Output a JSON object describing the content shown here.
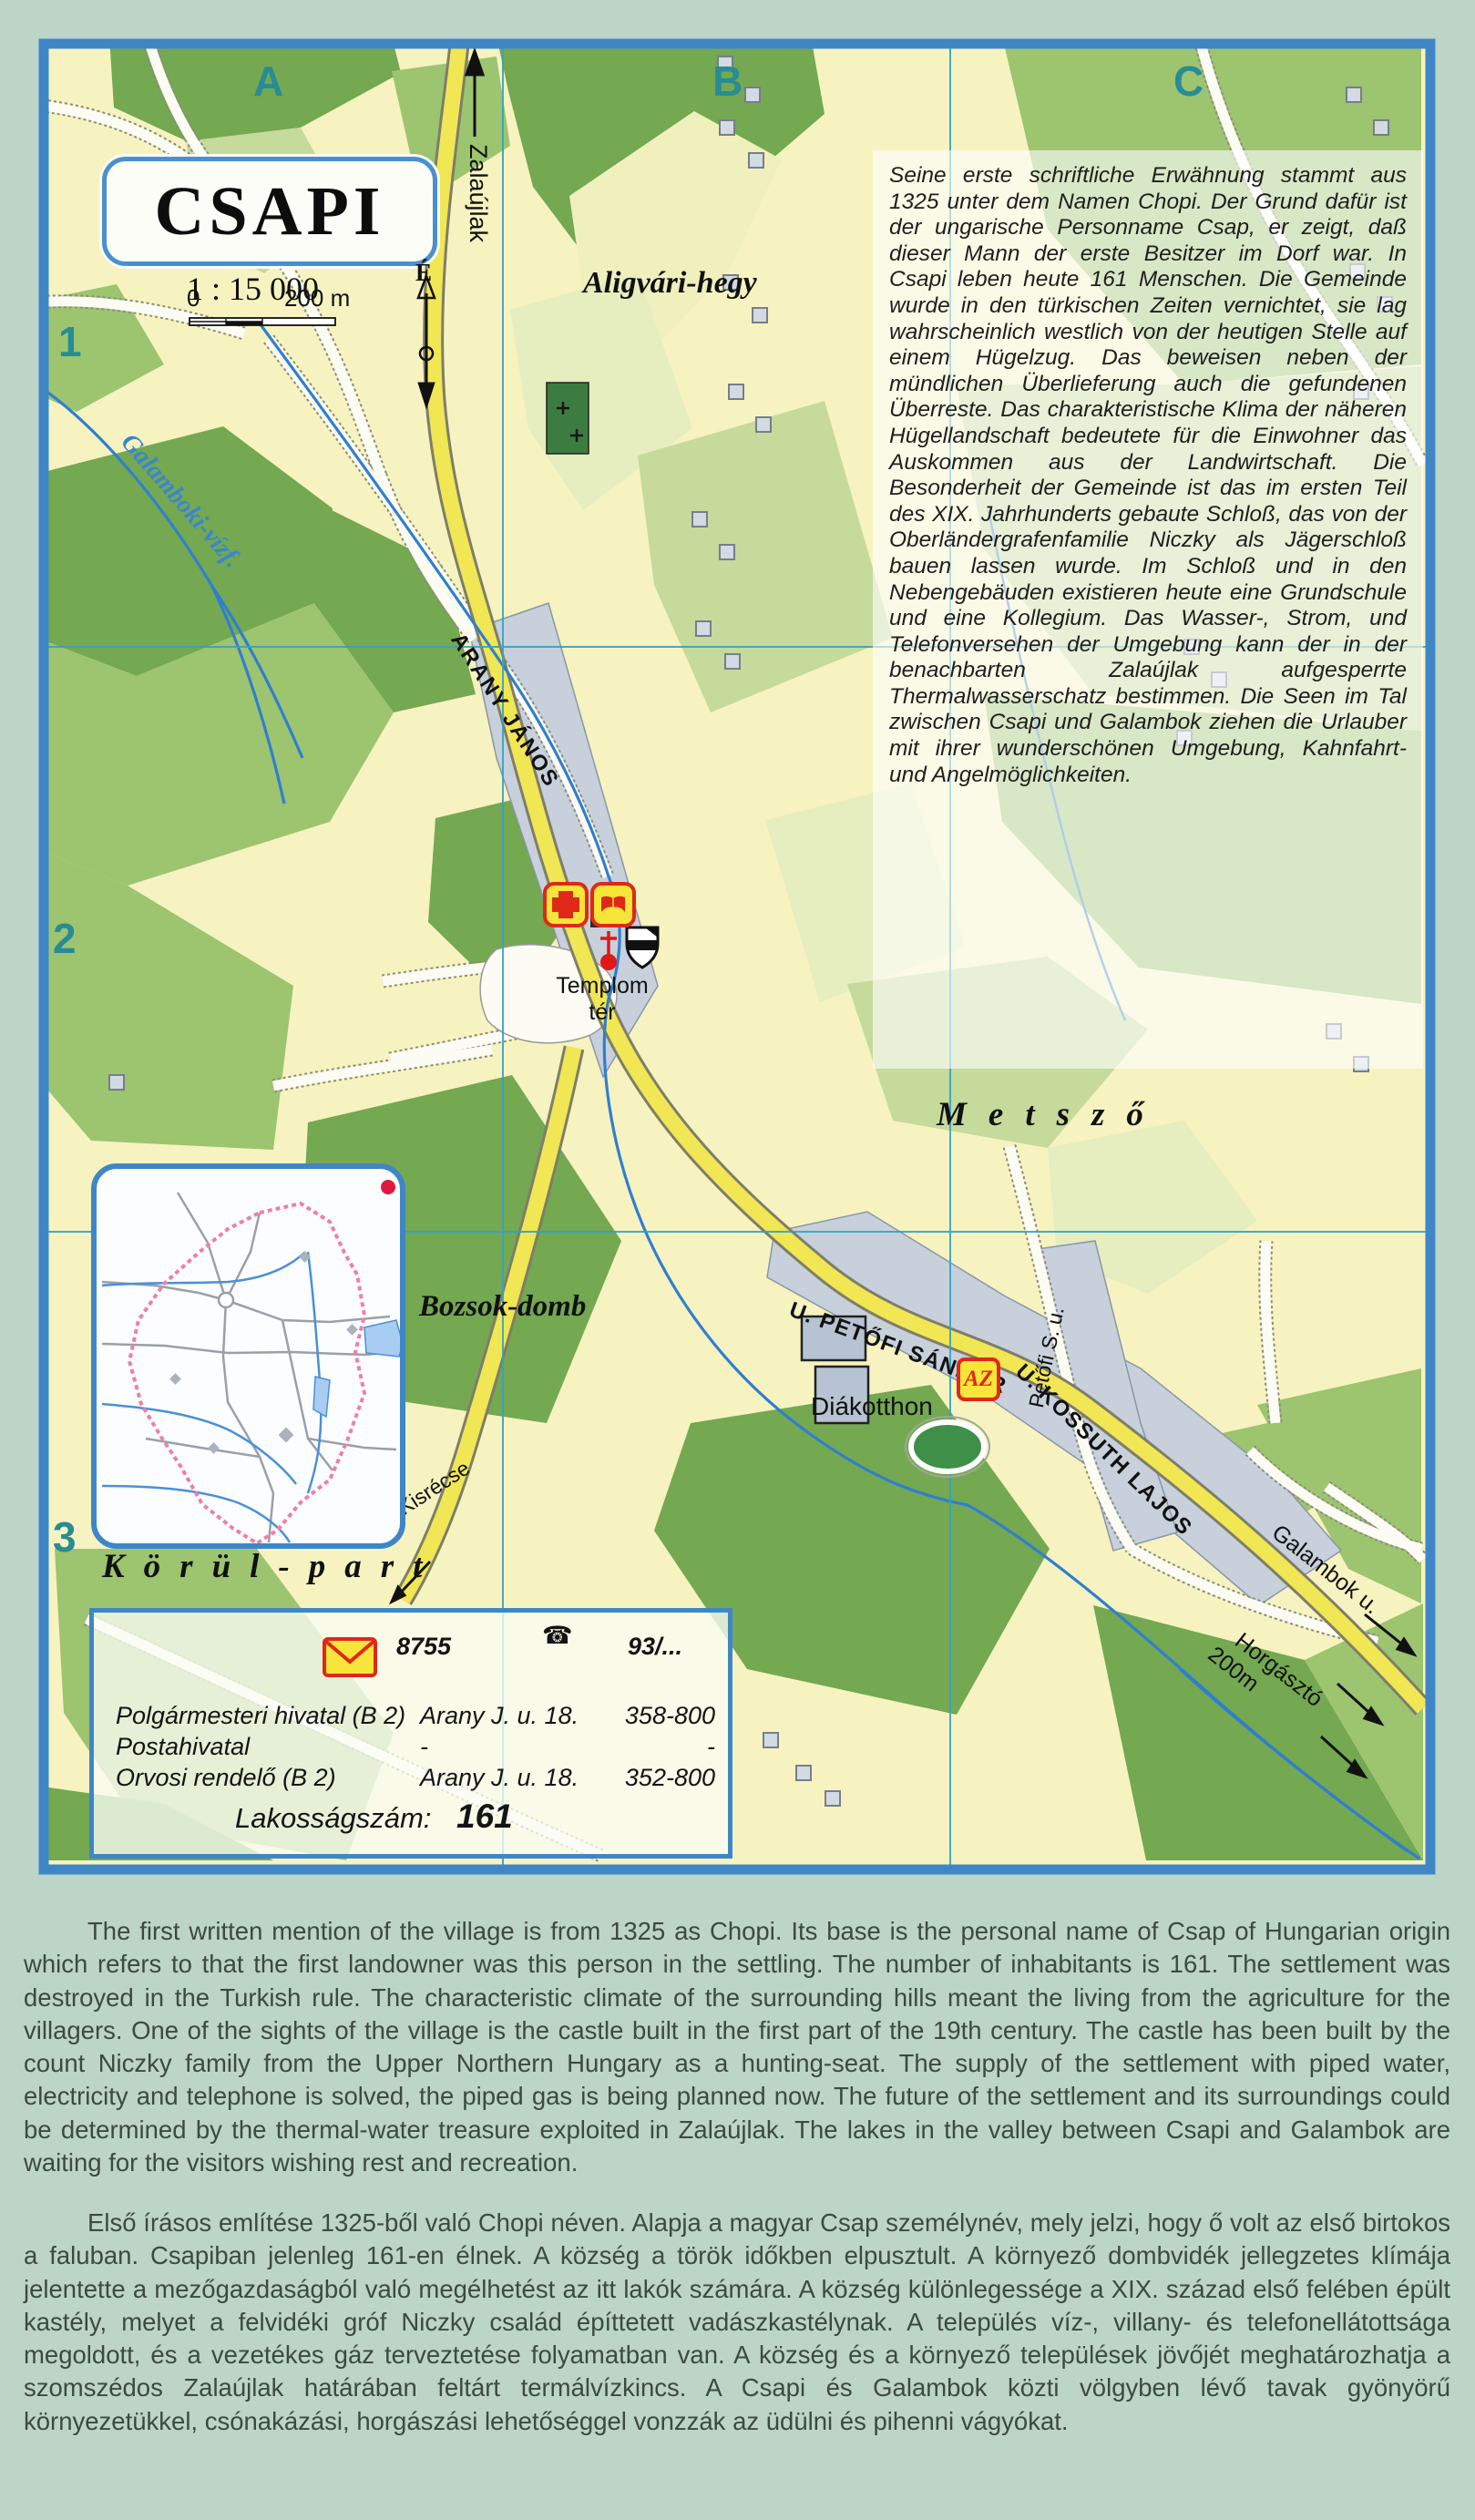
{
  "map": {
    "title": "CSAPI",
    "scale_text": "1 : 15 000",
    "scale_zero": "0",
    "scale_distance": "200 m",
    "north_label": "É",
    "grid": {
      "columns": [
        "A",
        "B",
        "C"
      ],
      "rows": [
        "1",
        "2",
        "3"
      ]
    },
    "labels": {
      "zalaujlak": "Zalaújlak",
      "aligvari_hegy": "Aligvári-hegy",
      "galamboki_vizf": "Galamboki-vízf.",
      "arany_janos": "ARANY JÁNOS",
      "templom_ter_line1": "Templom",
      "templom_ter_line2": "tér",
      "metszo": "Metsző",
      "bozsok_domb": "Bozsok-domb",
      "korul_part": "Körül-part",
      "diakotthon": "Diákotthon",
      "petofi_sandor": "U. PETŐFI SÁNDOR",
      "kossuth_lajos": "U. KOSSUTH LAJOS",
      "petofi_s_u": "Petőfi S. u.",
      "kisrecse": "Kisrécse",
      "galambok_u": "Galambok u.",
      "horgaszto": "Horgásztó",
      "horgaszto_distance": "200m",
      "az_badge": "AZ"
    },
    "icons": {
      "up_arrow": "↑",
      "phone_glyph": "☎"
    },
    "description_de": "Seine erste schriftliche Erwähnung stammt aus 1325 unter dem Namen Chopi. Der Grund dafür ist der ungarische Personname Csap, er zeigt, daß dieser Mann der erste Besitzer im Dorf war. In Csapi  leben heute 161 Menschen. Die Gemeinde wurde in den türkischen Zeiten vernichtet, sie lag wahrscheinlich westlich von der heutigen Stelle auf einem Hügelzug. Das beweisen neben der mündlichen Überlieferung auch die gefundenen Überreste. Das charakteristische Klima der näheren Hügellandschaft bedeutete für die Einwohner das Auskommen aus der Landwirtschaft. Die Besonderheit der Gemeinde ist das  im ersten Teil des XIX. Jahrhunderts gebaute Schloß, das von der Oberländergrafenfamilie Niczky als Jägerschloß bauen lassen wurde. Im Schloß und in den Nebengebäuden existieren heute eine Grundschule und eine Kollegium. Das Wasser-, Strom, und Telefonversehen der Umgebung kann der in der benachbarten Zalaújlak aufgesperrte Thermalwasserschatz bestimmen. Die Seen im Tal zwischen Csapi und Galambok ziehen die Urlauber mit ihrer wunderschönen Umgebung, Kahnfahrt- und Angelmöglichkeiten.",
    "info_box": {
      "postal_code": "8755",
      "phone_prefix": "93/...",
      "entries": [
        {
          "name": "Polgármesteri hivatal (B 2)",
          "address": "Arany J. u. 18.",
          "phone": "358-800"
        },
        {
          "name": "Postahivatal",
          "address": "-",
          "phone": "-"
        },
        {
          "name": "Orvosi rendelő (B 2)",
          "address": "Arany J. u.  18.",
          "phone": "352-800"
        }
      ],
      "population_label": "Lakosságszám:",
      "population_value": "161"
    }
  },
  "description_en": "The first written mention of the village is from 1325 as Chopi. Its base is the personal name of Csap of Hungarian origin which refers to that the first landowner was this person in the settling. The number of inhabitants is 161. The settlement was destroyed in the Turkish rule. The characteristic climate of the surrounding hills meant the living from the agriculture for the villagers. One of the sights of the village is the castle built in the first part of the 19th century. The castle has  been built by the count Niczky family from the Upper Northern Hungary as a hunting-seat. The supply of the settlement with piped water, electricity and telephone is solved,  the piped gas is being planned now. The future of the settlement and its surroundings could be determined by the thermal-water treasure exploited in Zalaújlak. The lakes in the valley between Csapi and Galambok are waiting for the visitors wishing rest and recreation.",
  "description_hu": "Első írásos említése 1325-ből való Chopi néven. Alapja a magyar Csap személynév, mely jelzi, hogy ő volt az első birtokos a faluban. Csapiban jelenleg 161-en élnek. A község a török időkben elpusztult. A környező dombvidék jellegzetes klímája jelentette a mezőgazdaságból való megélhetést az itt lakók számára. A község különlegessége a XIX. század első felében épült kastély, melyet a felvidéki gróf Niczky család építtetett vadászkastélynak. A település víz-, villany- és telefonellátottsága megoldott, és a vezetékes gáz terveztetése folyamatban van. A község és a környező települések jövőjét meghatározhatja a szomszédos Zalaújlak határában feltárt termálvízkincs. A Csapi és Galambok közti völgyben lévő tavak gyönyörű környezetükkel, csónakázási, horgászási lehetőséggel vonzzák az üdülni és pihenni vágyókat.",
  "colors": {
    "page_background": "#bdd5c6",
    "map_frame_blue": "#3f86c6",
    "map_cream": "#f6f3c0",
    "forest_dark_green": "#74a851",
    "forest_mid_green": "#9dc46f",
    "road_yellow": "#f1e654",
    "built_up_gray": "#c7d0db",
    "water_blue": "#2f7fd0",
    "grid_cyan": "#35a2c2",
    "grid_letter_teal": "#288c96",
    "icon_red": "#e02818",
    "icon_yellow": "#f7e539",
    "boundary_pink": "#ef7fa8"
  }
}
